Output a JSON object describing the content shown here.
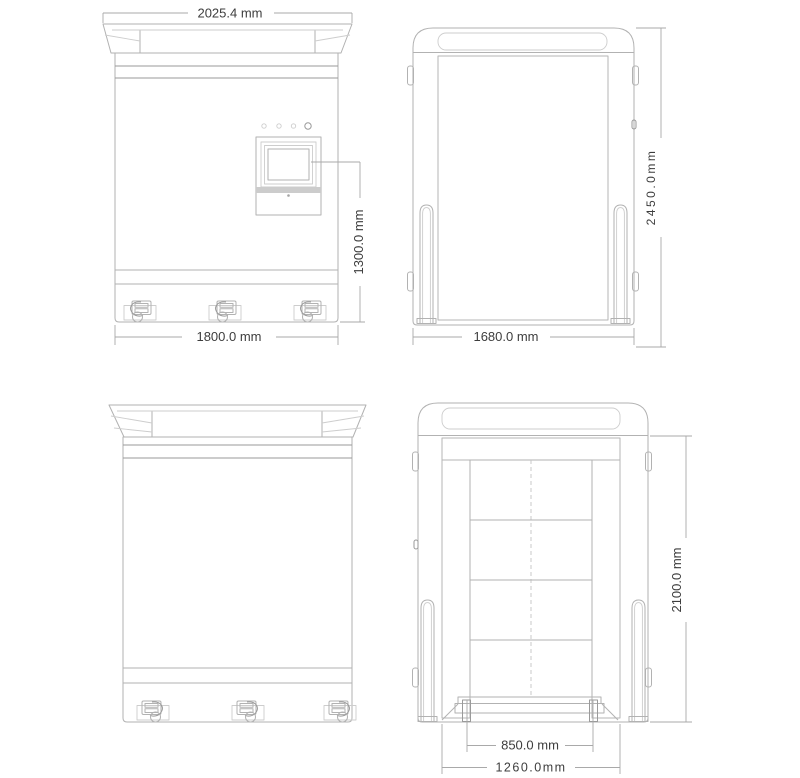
{
  "drawing": {
    "front_view": {
      "dim_top_width": "2025.4 mm",
      "dim_base_width": "1800.0 mm",
      "dim_screen_height": "1300.0 mm"
    },
    "shutter_view": {
      "dim_width": "1680.0 mm",
      "dim_height": "2450.0mm"
    },
    "open_view": {
      "dim_height": "2100.0 mm",
      "dim_pallet_width": "850.0 mm",
      "dim_door_width": "1260.0mm"
    },
    "colors": {
      "background": "#ffffff",
      "line": "#b2b2b2",
      "dark_line": "#9a9a9a",
      "dimension_text": "#3d3d3d",
      "screen_band": "#cccccc"
    }
  }
}
